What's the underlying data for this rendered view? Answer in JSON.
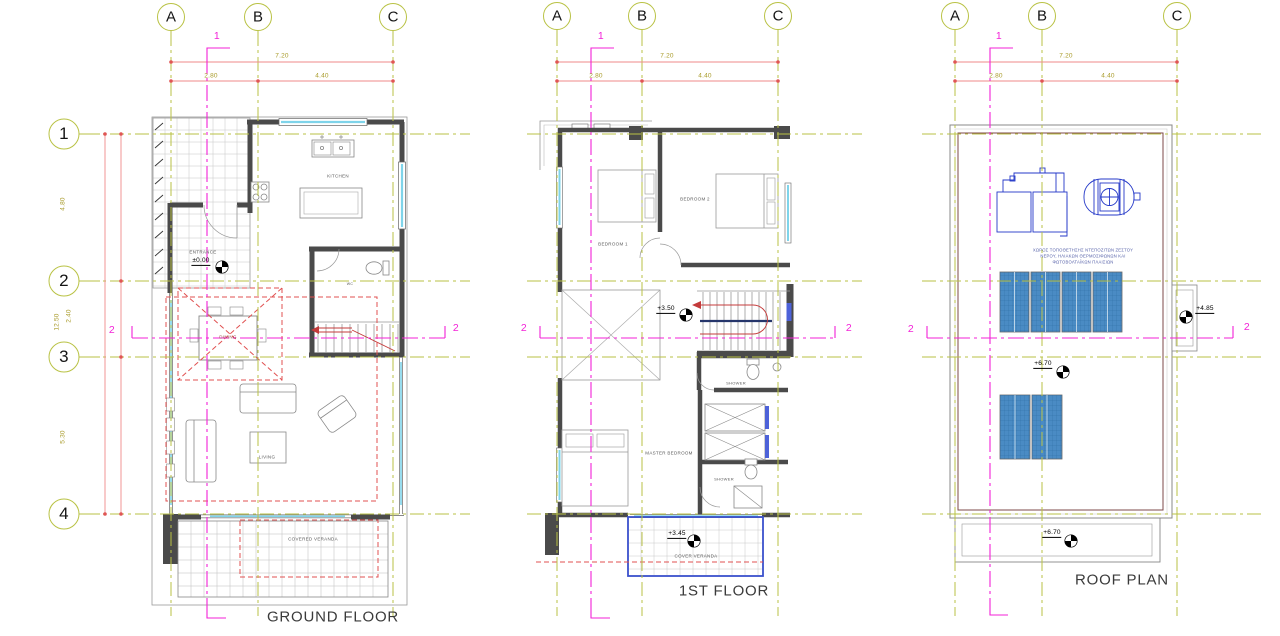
{
  "drawing": {
    "grid_columns": [
      "A",
      "B",
      "C"
    ],
    "grid_rows": [
      "1",
      "2",
      "3",
      "4"
    ],
    "dims": {
      "total_w": "7.20",
      "span_ab": "2.80",
      "span_bc": "4.40",
      "total_h": "12.50",
      "span_12": "4.80",
      "span_23": "2.40",
      "span_34": "5.30"
    },
    "sections": {
      "s1": "1",
      "s2": "2"
    },
    "plans": {
      "ground": {
        "title": "GROUND FLOOR",
        "labels": {
          "kitchen": "KITCHEN",
          "entrance": "ENTRANCE",
          "wc": "WC",
          "dining": "DINING",
          "living": "LIVING",
          "veranda": "COVERED VERANDA"
        },
        "levels": {
          "entrance": "±0.00"
        }
      },
      "first": {
        "title": "1ST FLOOR",
        "labels": {
          "bedroom1": "BEDROOM 1",
          "bedroom2": "BEDROOM 2",
          "shower1": "SHOWER",
          "master": "MASTER BEDROOM",
          "shower2": "SHOWER",
          "veranda": "COVER VERANDA"
        },
        "levels": {
          "landing": "+3.50",
          "veranda": "+3.45"
        }
      },
      "roof": {
        "title": "ROOF PLAN",
        "levels": {
          "side": "+4.85",
          "main": "+6.70",
          "veranda": "+6.70"
        },
        "note_lines": [
          "ΧΩΡΟΣ ΤΟΠΟΘΕΤΗΣΗΣ ΝΤΕΠΟΖΙΤΩΝ ΖΕΣΤΟΥ",
          "ΝΕΡΟΥ, ΗΛΙΑΚΩΝ ΘΕΡΜΟΣΙΦΩΝΩΝ ΚΑΙ",
          "ΦΩΤΟΒΟΛΤΑΪΚΩΝ ΠΛΑΙΣΙΩΝ"
        ]
      }
    },
    "colors": {
      "axis_grid": "#b9c244",
      "section_line": "#f321d7",
      "dimension_line": "#ef8a8a",
      "dimension_text": "#a89a28",
      "wall": "#4a4a4a",
      "glass": "#7fd4ea",
      "solar_panel": "#4a8bc4",
      "equipment": "#2438c8",
      "overlay_red": "#e05050",
      "parapet": "#7e4a4a"
    }
  }
}
